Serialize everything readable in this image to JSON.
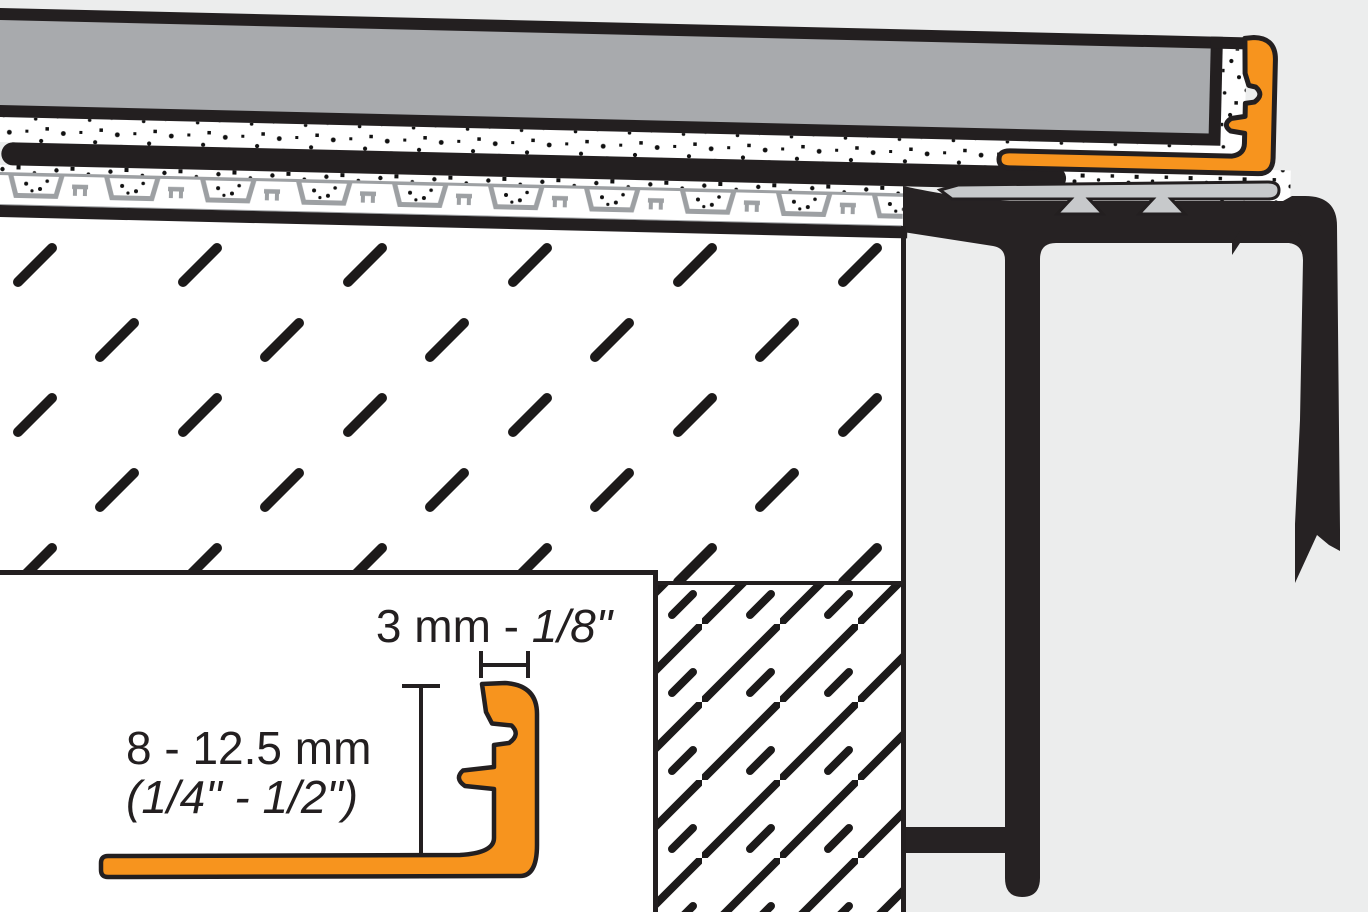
{
  "diagram": {
    "inset_labels": {
      "width_dim_prefix": "3 mm - ",
      "width_dim_inches": "1/8\"",
      "height_dim_metric": "8 - 12.5 mm",
      "height_dim_imperial": "(1/4\" - 1/2\")"
    },
    "colors": {
      "profile_orange": "#F7941E",
      "tile_gray": "#A8AAAD",
      "support_gray": "#C7C9CB",
      "membrane_gray": "#9DA0A3",
      "line_black": "#231F20",
      "background": "#ECEDED"
    }
  }
}
